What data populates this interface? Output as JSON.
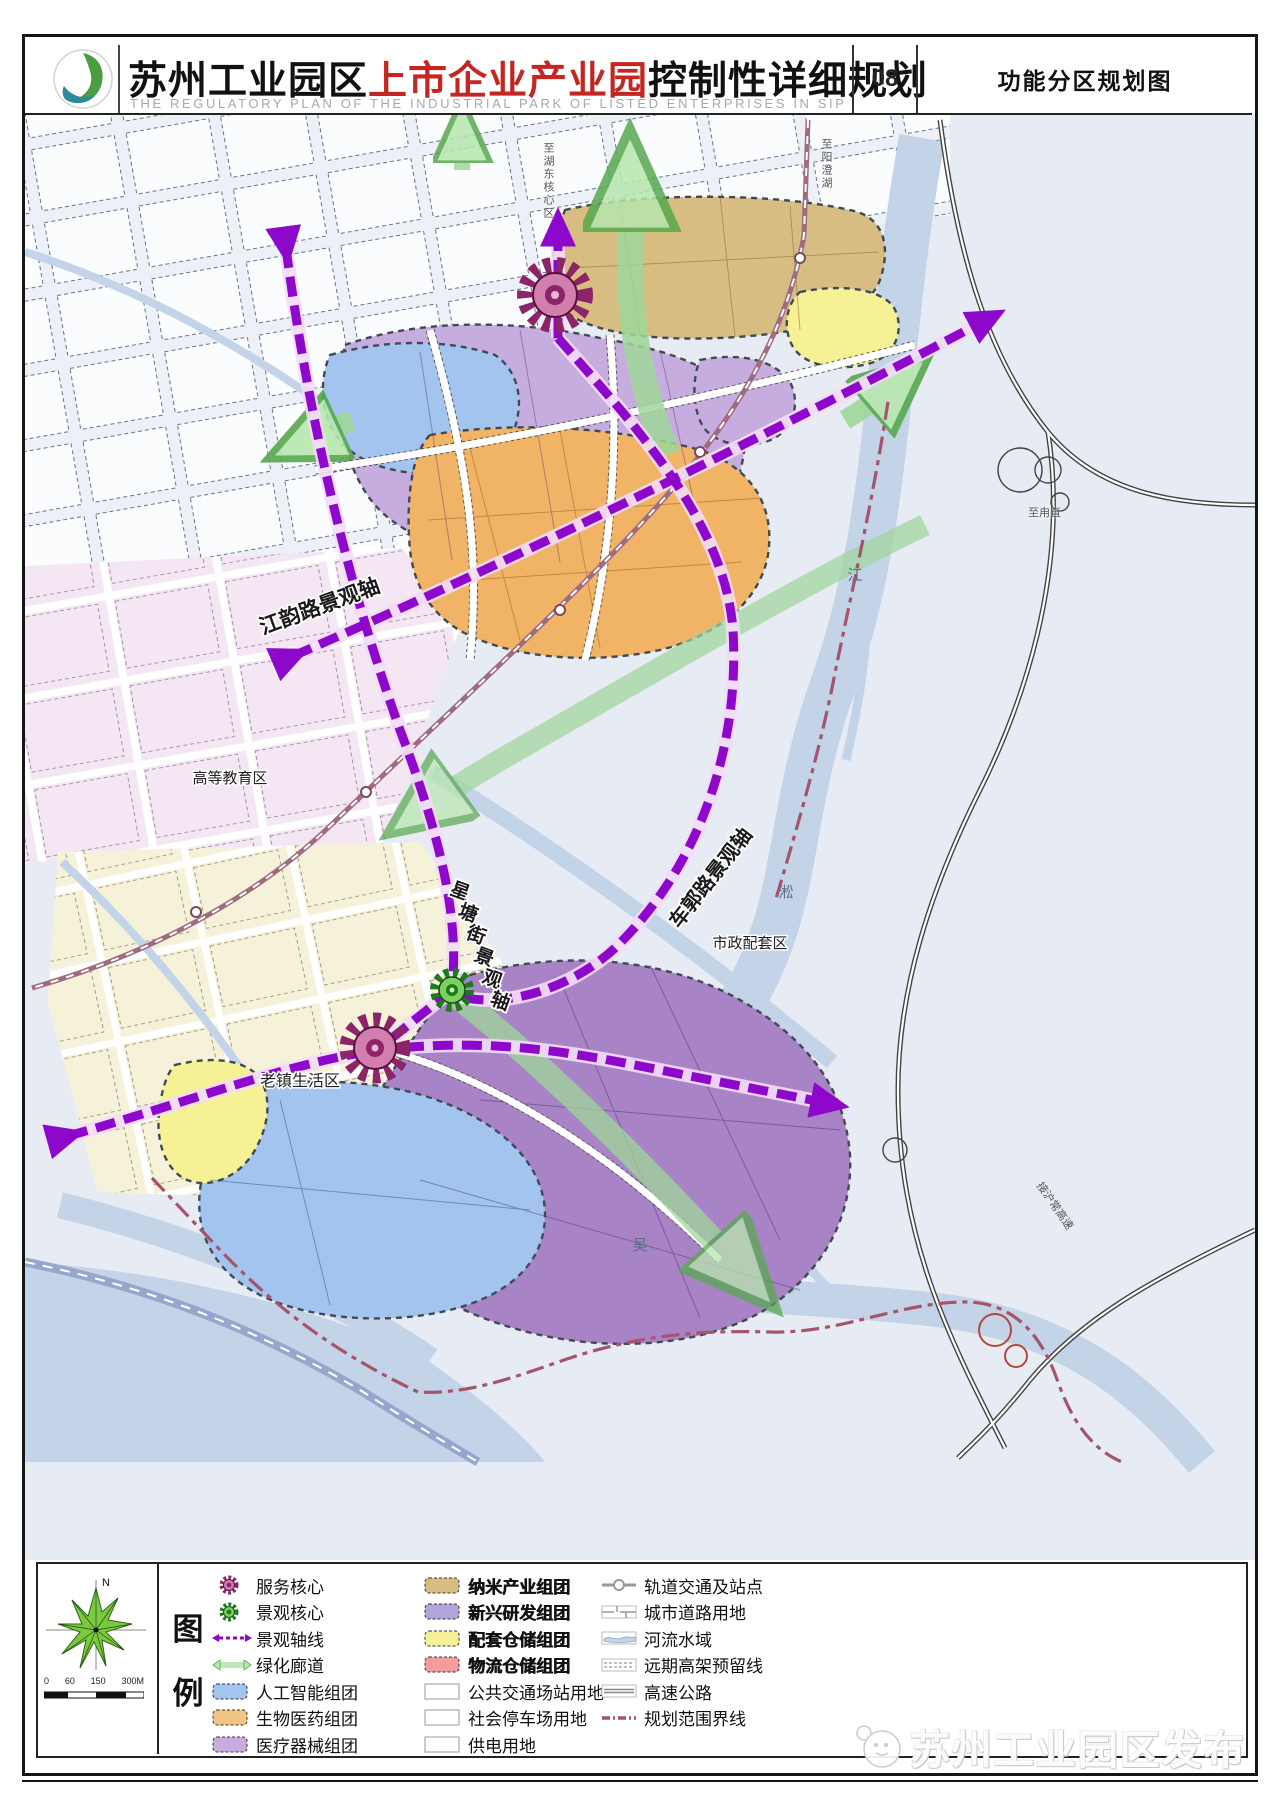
{
  "header": {
    "title_part1": "苏州工业园区",
    "title_highlight": "上市企业产业园",
    "title_part2": "控制性详细规划",
    "subtitle": "THE REGULATORY PLAN OF THE INDUSTRIAL PARK OF LISTED ENTERPRISES IN SIP",
    "sheet_number": "08",
    "sheet_title": "功能分区规划图"
  },
  "map": {
    "axis_labels": {
      "jiangyun": "江韵路景观轴",
      "xingtang_chars": [
        "星",
        "塘",
        "街",
        "景",
        "观",
        "轴"
      ],
      "cheguo": "车郭路景观轴"
    },
    "district_labels": {
      "higher_education": "高等教育区",
      "old_town": "老镇生活区",
      "municipal_support": "市政配套区"
    },
    "river_chars": [
      "江",
      "淞",
      "吴"
    ],
    "edge_labels": {
      "to_hudong": "至湖东核心区",
      "to_yangcheng": "至阳澄湖",
      "to_luzhi": "至甪直",
      "to_expressway": "接沪常高速"
    }
  },
  "legend": {
    "title_chars": [
      "图",
      "例"
    ],
    "col1": [
      {
        "label": "服务核心",
        "color": "#8c2567"
      },
      {
        "label": "景观核心",
        "color": "#2f9a33"
      },
      {
        "label": "景观轴线",
        "color": "#8d08cb"
      },
      {
        "label": "绿化廊道",
        "color": "#a8dba3"
      },
      {
        "label": "人工智能组团",
        "color": "#a2c4ef"
      },
      {
        "label": "生物医药组团",
        "color": "#f0c585"
      },
      {
        "label": "医疗器械组团",
        "color": "#c7addf"
      }
    ],
    "col2": [
      {
        "label": "纳米产业组团",
        "color": "#d8bd82"
      },
      {
        "label": "新兴研发组团",
        "color": "#b3a5d9"
      },
      {
        "label": "配套仓储组团",
        "color": "#f5f194"
      },
      {
        "label": "物流仓储组团",
        "color": "#f49c9c"
      },
      {
        "label": "公共交通场站用地",
        "color": "#ffffff"
      },
      {
        "label": "社会停车场用地",
        "color": "#ffffff"
      },
      {
        "label": "供电用地",
        "color": "#ffffff"
      }
    ],
    "col3": [
      {
        "label": "轨道交通及站点"
      },
      {
        "label": "城市道路用地"
      },
      {
        "label": "河流水域"
      },
      {
        "label": "远期高架预留线"
      },
      {
        "label": "高速公路"
      },
      {
        "label": "规划范围界线"
      }
    ]
  },
  "compass": {
    "north_label": "N",
    "scale_labels": [
      "0",
      "60",
      "150",
      "300M"
    ]
  },
  "watermark": {
    "text": "苏州工业园区发布"
  }
}
